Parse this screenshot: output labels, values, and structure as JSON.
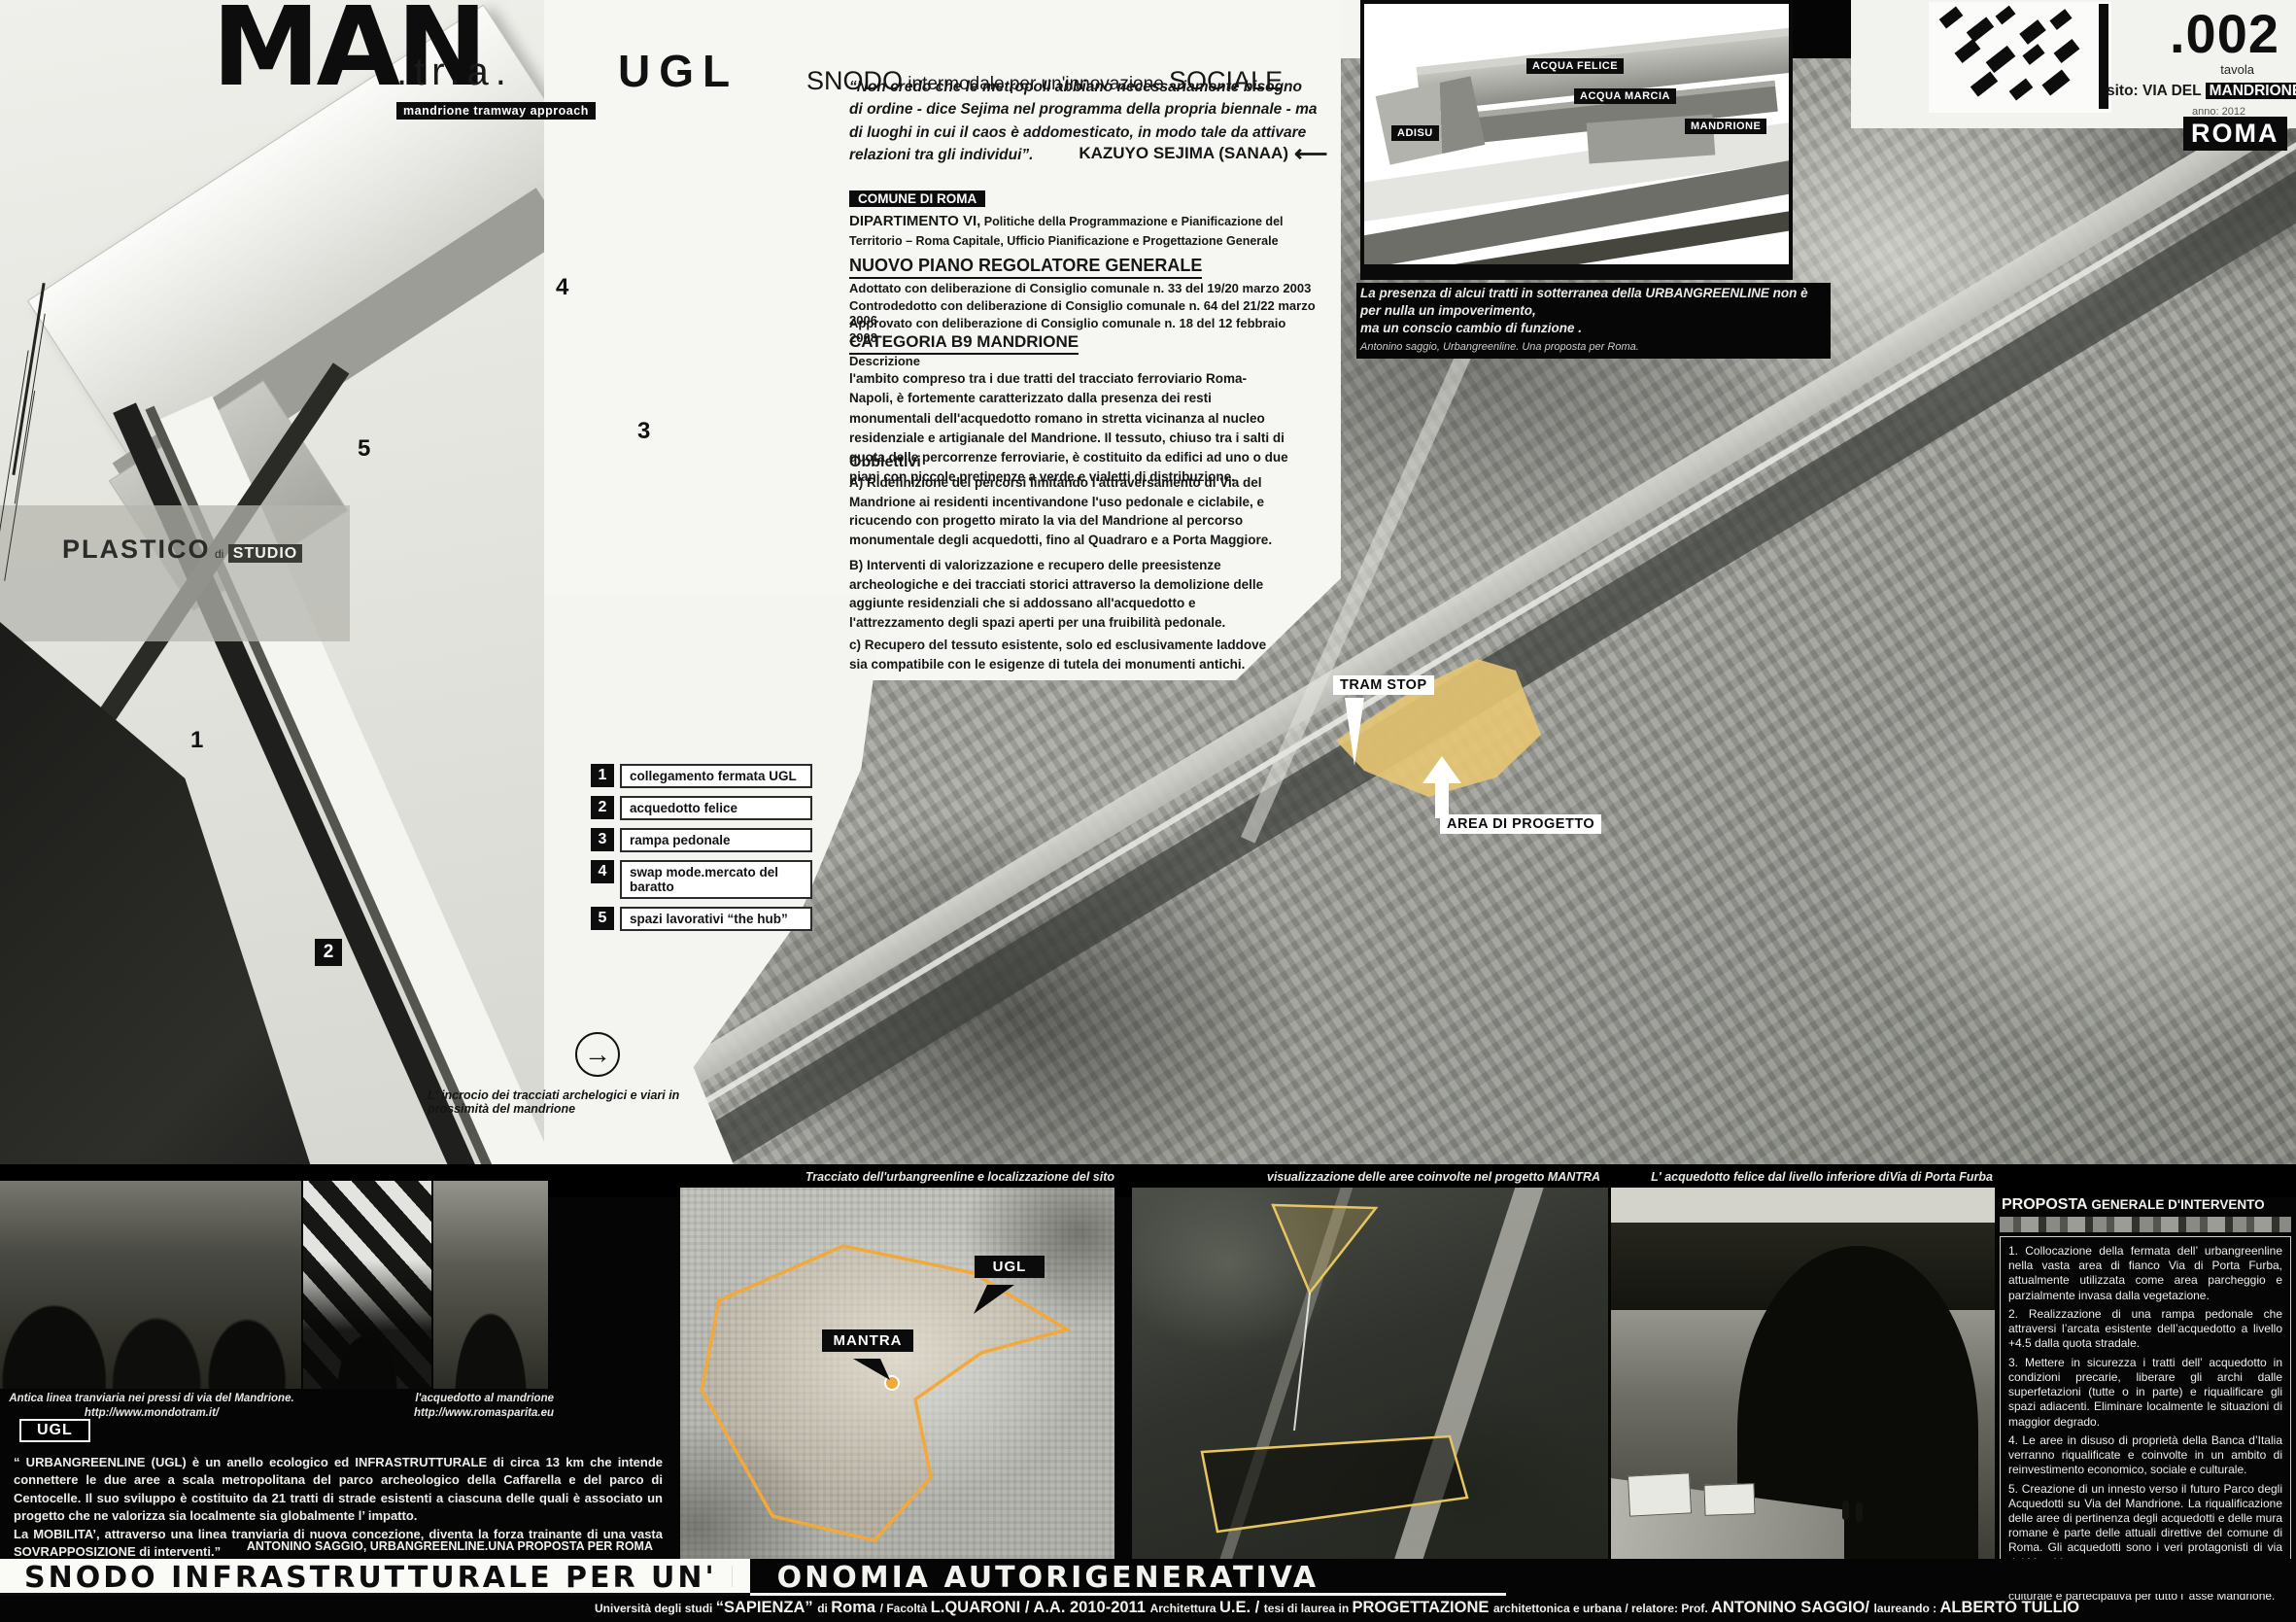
{
  "header": {
    "title_main": "MAN",
    "title_mid": ".tr.a.",
    "title_end": "UGL",
    "tag": "mandrione tramway approach",
    "tagline_a": "SNODO",
    "tagline_b": " intermodale per un'innovazione ",
    "tagline_c": "SOCIALE"
  },
  "quote": {
    "text": "“Non credo che le metropoli abbiano necessariamente  bisogno di  ordine - dice Sejima nel programma della propria biennale - ma di luoghi in cui il caos è addomesticato, in modo tale da attivare relazioni tra gli individui”.",
    "author": "KAZUYO SEJIMA (SANAA)",
    "arrow": "⟵"
  },
  "column": {
    "comune_chip": "COMUNE DI ROMA",
    "dip_bold": "DIPARTIMENTO VI,",
    "dip_rest": " Politiche della Programmazione e Pianificazione del Territorio – Roma Capitale,  Ufficio Pianificazione e Progettazione Generale",
    "piano_title": "NUOVO PIANO REGOLATORE GENERALE",
    "piano_lines": [
      "Adottato con deliberazione di Consiglio comunale n. 33 del 19/20 marzo 2003",
      "Controdedotto con deliberazione di Consiglio comunale n. 64 del 21/22 marzo 2006",
      "Approvato con deliberazione di Consiglio comunale n. 18 del 12 febbraio 2008"
    ],
    "categoria_title": "CATEGORIA  B9 MANDRIONE",
    "descrizione_label": "Descrizione",
    "descrizione": "l'ambito compreso tra i due tratti del tracciato ferroviario Roma-Napoli, è fortemente caratterizzato dalla presenza dei resti monumentali dell'acquedotto romano in stretta vicinanza al nucleo residenziale e artigianale del Mandrione. Il tessuto, chiuso tra i salti di quota delle percorrenze ferroviarie, è costituito da edifici ad uno o due piani con piccole pretinenze a verde e vialetti di distribuzione.",
    "obbiettivi_label": "Obbiettivi",
    "obb_a": "A) Ridefinizione dei percorsi limitando l'attraversamento di Via del Mandrione ai residenti incentivandone l'uso pedonale e ciclabile, e ricucendo con progetto mirato la via del Mandrione al percorso monumentale degli acquedotti, fino al Quadraro e a Porta Maggiore.",
    "obb_b": "B) Interventi di valorizzazione e recupero delle preesistenze archeologiche e dei tracciati storici attraverso la demolizione delle aggiunte residenziali che si addossano all'acquedotto e l'attrezzamento degli spazi aperti per una fruibilità pedonale.",
    "obb_c": "c) Recupero del tessuto esistente, solo ed esclusivamente laddove sia compatibile con le esigenze di tutela dei monumenti  antichi."
  },
  "model": {
    "plastico": "PLASTICO",
    "di": "di",
    "studio": "STUDIO",
    "markers": [
      {
        "n": "1"
      },
      {
        "n": "2"
      },
      {
        "n": "3"
      },
      {
        "n": "4"
      },
      {
        "n": "5"
      }
    ]
  },
  "legend": {
    "items": [
      {
        "num": "1",
        "label": "collegamento fermata UGL"
      },
      {
        "num": "2",
        "label": "acquedotto felice"
      },
      {
        "num": "3",
        "label": "rampa pedonale"
      },
      {
        "num": "4",
        "label": "swap mode.mercato del baratto"
      },
      {
        "num": "5",
        "label": "spazi lavorativi “the hub”"
      }
    ]
  },
  "arrow_note": {
    "icon": "→",
    "caption": "L' incrocio dei tracciati archelogici e viari in prossimità del mandrione"
  },
  "diagram": {
    "labels": {
      "felice": "ACQUA FELICE",
      "marcia": "ACQUA MARCIA",
      "adisu": "ADISU",
      "mandrione": "MANDRIONE"
    },
    "caption1": "La presenza di alcui tratti  in sotterranea della URBANGREENLINE non è per nulla un impoverimento,",
    "caption2": "ma un  conscio cambio di funzione .",
    "caption3": "Antonino saggio,  Urbangreenline. Una proposta per Roma."
  },
  "titleblock": {
    "number": ".002",
    "number_sub": "tavola",
    "sito_prefix": "sito: VIA DEL ",
    "sito_chip": "MANDRIONE",
    "anno": "anno: 2012",
    "city": "ROMA"
  },
  "aerial": {
    "tram_stop": "TRAM STOP",
    "area_label": "AREA DI PROGETTO",
    "highlight_color": "#e7c772"
  },
  "photos": {
    "antica_caption": "Antica linea tranviaria nei pressi di via del Mandrione.",
    "antica_url": "http://www.mondotram.it/",
    "acq_caption": "l'acquedotto al mandrione",
    "acq_url": "http://www.romasparita.eu",
    "tracciato_caption": "Tracciato dell'urbangreenline e localizzazione del sito",
    "mantra_caption": "visualizzazione delle aree coinvolte nel progetto MANTRA",
    "furba_caption": "L' acquedotto felice dal livello inferiore diVia di Porta Furba"
  },
  "map": {
    "ugl": "UGL",
    "mantra": "MANTRA",
    "line_color": "#f2a93b"
  },
  "ugl_block": {
    "chip": "UGL",
    "text": "“ URBANGREENLINE (UGL) è un anello ecologico ed INFRASTRUTTURALE di circa 13 km che intende connettere le due aree a scala metropolitana del parco archeologico della Caffarella e del parco di Centocelle. Il suo sviluppo è costituito da 21 tratti di strade esistenti a ciascuna delle quali è associato un progetto che ne valorizza sia localmente sia globalmente l’ impatto.\nLa MOBILITA’, attraverso una linea tranviaria di nuova concezione, diventa la forza trainante di una vasta SOVRAPPOSIZIONE di interventi.”",
    "attribution": "ANTONINO SAGGIO, URBANGREENLINE.UNA PROPOSTA PER ROMA"
  },
  "proposta": {
    "title_bold": "PROPOSTA",
    "title_rest": " GENERALE D'INTERVENTO",
    "items": [
      "1. Collocazione della fermata dell’ urbangreenline nella vasta area di fianco Via di Porta Furba, attualmente utilizzata come area parcheggio e parzialmente invasa dalla vegetazione.",
      "2. Realizzazione di una rampa pedonale che attraversi l’arcata esistente dell’acquedotto a livello +4.5 dalla quota stradale.",
      "3.  Mettere in sicurezza i tratti dell’ acquedotto in condizioni precarie, liberare gli archi dalle superfetazioni (tutte o in parte) e riqualificare gli spazi adiacenti. Eliminare localmente le situazioni di maggior degrado.",
      "4.  Le aree in disuso di proprietà della Banca d’Italia verranno riqualificate e coinvolte in un ambito di reinvestimento economico, sociale e culturale.",
      "5. Creazione di un innesto verso il futuro Parco degli Acquedotti su Via del Mandrione. La riqualificazione delle aree di pertinenza degli acquedotti e delle mura romane è parte delle attuali direttive del comune di Roma. Gli acquedotti sono i veri protagonisti di via del Mandrione.",
      "6. Attivare processi rivitalizzanti in chiave sociale, culturale e partecipativa per tutto l’ asse Mandrione."
    ]
  },
  "footer": {
    "title": "SNODO INFRASTRUTTURALE PER UN' ECONOMIA AUTORIGENERATIVA",
    "credits": [
      "Università degli studi ",
      "“SAPIENZA” ",
      "di ",
      "Roma ",
      "/ ",
      "Facoltà ",
      "L.QUARONI ",
      "/ ",
      "A.A. 2010-2011 ",
      "Architettura ",
      "U.E. ",
      "/ ",
      "tesi di laurea in ",
      "PROGETTAZIONE ",
      "architettonica e urbana ",
      "/ ",
      "relatore: Prof. ",
      "ANTONINO SAGGIO/ ",
      "laureando : ",
      "ALBERTO TULLIO"
    ]
  }
}
